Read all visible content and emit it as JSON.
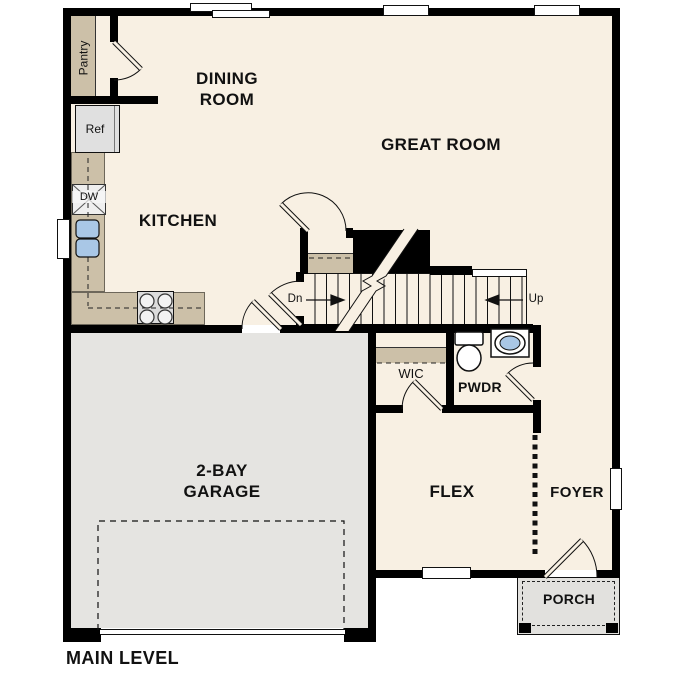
{
  "title": "MAIN LEVEL",
  "colors": {
    "floor": "#f8f0e3",
    "cabinet": "#ccc0a8",
    "garage_floor": "#e5e4e1",
    "porch_floor": "#e2e1de",
    "fixture_blue": "#a9c7e6",
    "wall": "#000000"
  },
  "rooms": {
    "pantry": {
      "label": "Pantry"
    },
    "dining": {
      "line1": "DINING",
      "line2": "ROOM"
    },
    "great": {
      "label": "GREAT ROOM"
    },
    "kitchen": {
      "label": "KITCHEN"
    },
    "garage": {
      "line1": "2-BAY",
      "line2": "GARAGE"
    },
    "flex": {
      "label": "FLEX"
    },
    "foyer": {
      "label": "FOYER"
    },
    "porch": {
      "label": "PORCH"
    },
    "pwdr": {
      "label": "PWDR"
    },
    "wic": {
      "label": "WIC"
    }
  },
  "stairs": {
    "down_label": "Dn",
    "up_label": "Up"
  },
  "appliances": {
    "refrigerator_label": "Ref",
    "dishwasher_label": "DW"
  }
}
